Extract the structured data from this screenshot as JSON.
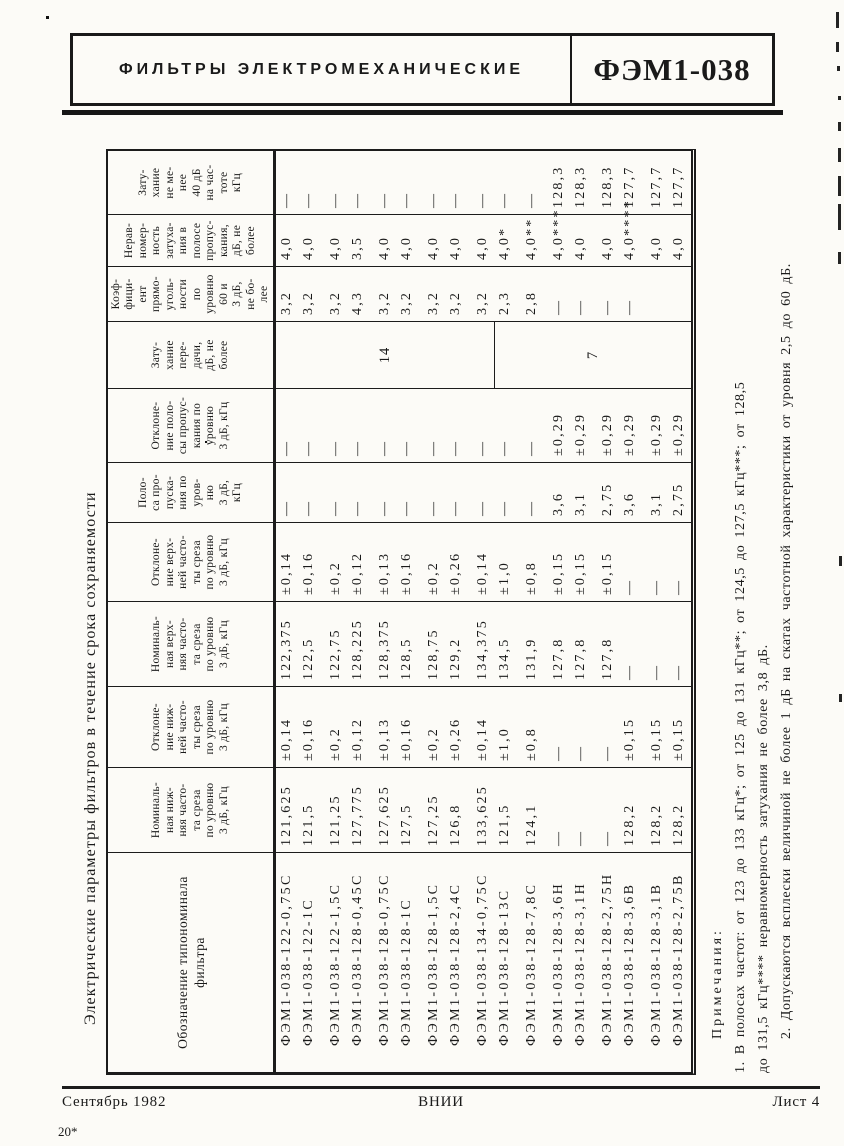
{
  "header": {
    "title": "ФИЛЬТРЫ  ЭЛЕКТРОМЕХАНИЧЕСКИЕ",
    "code": "ФЭМ1-038"
  },
  "table": {
    "caption": "Электрические параметры фильтров в течение срока сохраняемости",
    "col_widths": [
      219,
      84,
      80,
      84,
      78,
      59,
      73,
      66,
      54,
      51,
      63
    ],
    "columns": [
      {
        "key": "designation",
        "header": "Обозначение типономинала\nфильтра"
      },
      {
        "key": "nominal_lower_cutoff",
        "header": "Номиналь-\nная ниж-\nняя часто-\nта среза\nпо уровню\n3 дБ, кГц"
      },
      {
        "key": "lower_cutoff_deviation",
        "header": "Отклоне-\nние ниж-\nней часто-\nты среза\nпо уровню\n3 дБ, кГц"
      },
      {
        "key": "nominal_upper_cutoff",
        "header": "Номиналь-\nная верх-\nняя часто-\nта среза\nпо уровню\n3 дБ, кГц"
      },
      {
        "key": "upper_cutoff_deviation",
        "header": "Отклоне-\nние верх-\nней часто-\nты среза\nпо уровню\n3 дБ, кГц"
      },
      {
        "key": "passband",
        "header": "Поло-\nса про-\nпуска-\nния по\nуров-\nню\n3 дБ,\nкГц"
      },
      {
        "key": "passband_deviation",
        "header": "Отклоне-\nние поло-\nсы пропус-\nкания по\nуровню\n3 дБ, кГц"
      },
      {
        "key": "transfer_attenuation",
        "header": "Зату-\nхание\nпере-\nдачи,\nдБ, не\nболее"
      },
      {
        "key": "rectangularity_coefficient",
        "header": "Коэф-\nфици-\nент\nпрямо-\nуголь-\nности\nпо\nуровню\n60 и\n3 дБ,\nне бо-\nлее"
      },
      {
        "key": "attenuation_unevenness",
        "header": "Нерав-\nномер-\nность\nзатуха-\nния в\nполосе\nпропус-\nкания,\nдБ, не\nболее"
      },
      {
        "key": "attenuation_40db_frequency",
        "header": "Зату-\nхание\nне ме-\nнее\n40 дБ\nна час-\nтоте\nкГц"
      }
    ],
    "rows": [
      [
        "ФЭМ1-038-122-0,75С",
        "121,625",
        "±0,14",
        "122,375",
        "±0,14",
        "—",
        "—",
        "",
        "3,2",
        "4,0",
        "—"
      ],
      [
        "ФЭМ1-038-122-1С",
        "121,5",
        "±0,16",
        "122,5",
        "±0,16",
        "—",
        "—",
        "",
        "3,2",
        "4,0",
        "—"
      ],
      [
        "ФЭМ1-038-122-1,5С",
        "121,25",
        "±0,2",
        "122,75",
        "±0,2",
        "—",
        "—",
        "",
        "3,2",
        "4,0",
        "—"
      ],
      [
        "ФЭМ1-038-128-0,45С",
        "127,775",
        "±0,12",
        "128,225",
        "±0,12",
        "—",
        "—",
        "",
        "4,3",
        "3,5",
        "—"
      ],
      [
        "ФЭМ1-038-128-0,75С",
        "127,625",
        "±0,13",
        "128,375",
        "±0,13",
        "—",
        "—",
        "",
        "3,2",
        "4,0",
        "—"
      ],
      [
        "ФЭМ1-038-128-1С",
        "127,5",
        "±0,16",
        "128,5",
        "±0,16",
        "—",
        "—",
        "",
        "3,2",
        "4,0",
        "—"
      ],
      [
        "ФЭМ1-038-128-1,5С",
        "127,25",
        "±0,2",
        "128,75",
        "±0,2",
        "—",
        "—",
        "",
        "3,2",
        "4,0",
        "—"
      ],
      [
        "ФЭМ1-038-128-2,4С",
        "126,8",
        "±0,26",
        "129,2",
        "±0,26",
        "—",
        "—",
        "",
        "3,2",
        "4,0",
        "—"
      ],
      [
        "ФЭМ1-038-134-0,75С",
        "133,625",
        "±0,14",
        "134,375",
        "±0,14",
        "—",
        "—",
        "",
        "3,2",
        "4,0",
        "—"
      ],
      [
        "ФЭМ1-038-128-13С",
        "121,5",
        "±1,0",
        "134,5",
        "±1,0",
        "—",
        "—",
        "",
        "2,3",
        "4,0*",
        "—"
      ],
      [
        "ФЭМ1-038-128-7,8С",
        "124,1",
        "±0,8",
        "131,9",
        "±0,8",
        "—",
        "—",
        "",
        "2,8",
        "4,0**",
        "—"
      ],
      [
        "ФЭМ1-038-128-3,6Н",
        "—",
        "—",
        "127,8",
        "±0,15",
        "3,6",
        "±0,29",
        "",
        "—",
        "4,0***",
        "128,3"
      ],
      [
        "ФЭМ1-038-128-3,1Н",
        "—",
        "—",
        "127,8",
        "±0,15",
        "3,1",
        "±0,29",
        "",
        "—",
        "4,0",
        "128,3"
      ],
      [
        "ФЭМ1-038-128-2,75Н",
        "—",
        "—",
        "127,8",
        "±0,15",
        "2,75",
        "±0,29",
        "",
        "—",
        "4,0",
        "128,3"
      ],
      [
        "ФЭМ1-038-128-3,6В",
        "128,2",
        "±0,15",
        "—",
        "—",
        "3,6",
        "±0,29",
        "",
        "—",
        "4,0****",
        "127,7"
      ],
      [
        "ФЭМ1-038-128-3,1В",
        "128,2",
        "±0,15",
        "—",
        "—",
        "3,1",
        "±0,29",
        "",
        "",
        "4,0",
        "127,7"
      ],
      [
        "ФЭМ1-038-128-2,75В",
        "128,2",
        "±0,15",
        "—",
        "—",
        "2,75",
        "±0,29",
        "",
        "",
        "4,0",
        "127,7"
      ]
    ],
    "attenuation_spans": [
      {
        "value": "14",
        "rows": "1-9",
        "height": 218
      },
      {
        "value": "7",
        "rows": "10-17",
        "height": 196
      }
    ],
    "gap_after": [
      1,
      3,
      5,
      7,
      9,
      10,
      12,
      14
    ]
  },
  "notes": {
    "lines": [
      {
        "indent": true,
        "label": "Примечания:",
        "text": "1. В полосах частот: от 123 до 133 кГц*; от 125 до 131 кГц**; от 124,5 до 127,5 кГц***; от 128,5"
      },
      {
        "indent": false,
        "label": "",
        "text": "до 131,5 кГц**** неравномерность затухания не более 3,8 дБ."
      },
      {
        "indent": true,
        "label": "",
        "text": "2. Допускаются всплески величиной не более 1 дБ на скатах частотной характеристики от уровня 2,5 до 60 дБ."
      }
    ]
  },
  "footer": {
    "date": "Сентябрь 1982",
    "org": "ВНИИ",
    "sheet": "Лист 4",
    "press_mark": "20*"
  }
}
